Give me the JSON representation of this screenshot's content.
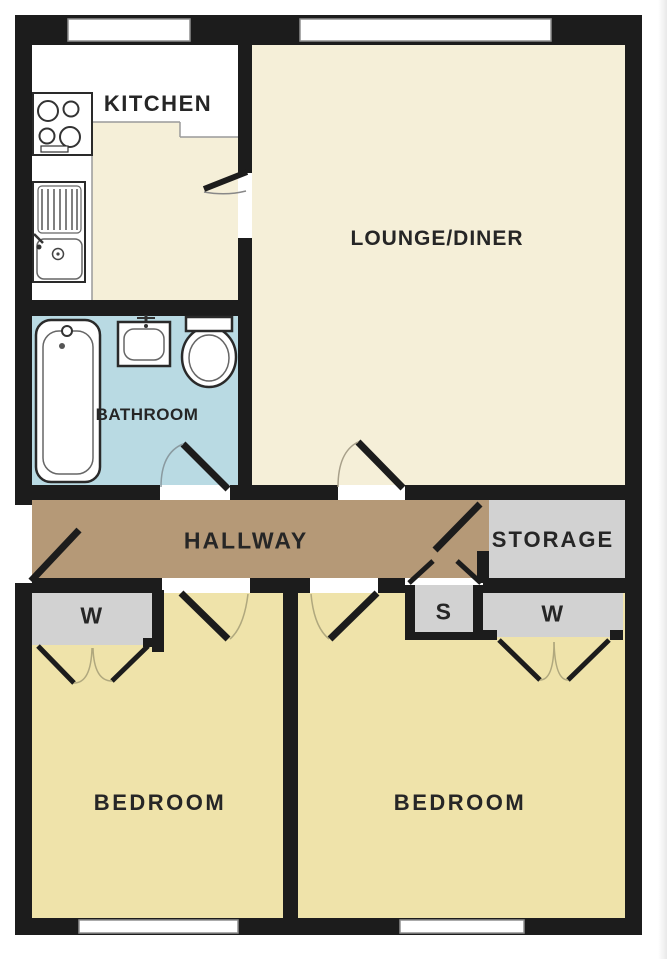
{
  "plan_title": "Two bedroom flat floor plan",
  "labels": {
    "kitchen": "KITCHEN",
    "lounge_diner": "LOUNGE/DINER",
    "bathroom": "BATHROOM",
    "hallway": "HALLWAY",
    "storage": "STORAGE",
    "wardrobe_left": "W",
    "cupboard_s": "S",
    "wardrobe_right": "W",
    "bedroom_left": "BEDROOM",
    "bedroom_right": "BEDROOM"
  },
  "icons": {
    "bathtub": "bathtub-icon",
    "basin": "basin-icon",
    "toilet": "toilet-icon",
    "hob": "hob-icon",
    "kitchen_sink": "kitchen-sink-icon",
    "door": "door-swing-icon",
    "window": "window-icon"
  },
  "colors": {
    "wall": "#1c1c1c",
    "cream": "#f5efd8",
    "yellow": "#efe3aa",
    "blue": "#b9dae3",
    "tan": "#b59977",
    "gray": "#d2d2d2",
    "white": "#ffffff",
    "line": "#555555",
    "winline": "#8f8f8f",
    "label": "#262626"
  }
}
